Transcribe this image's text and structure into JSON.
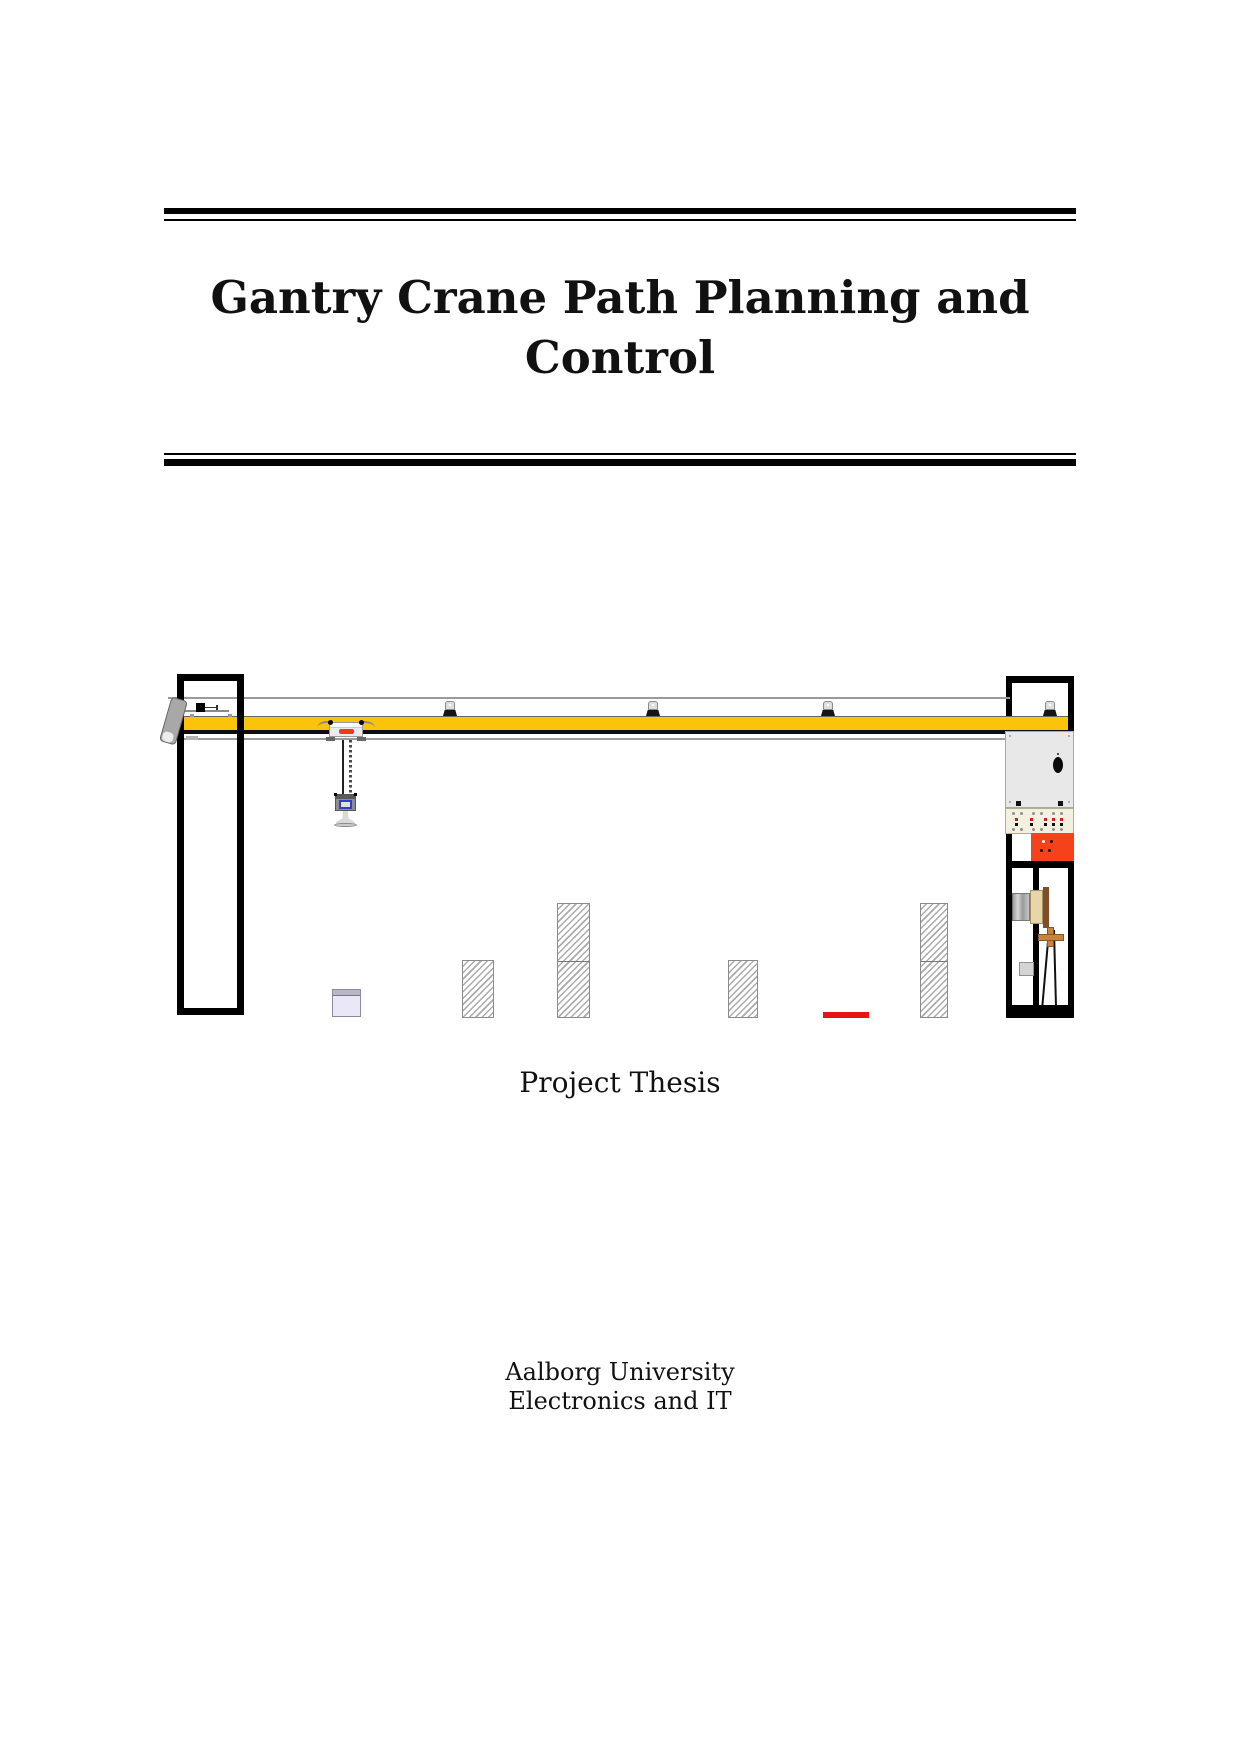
{
  "header": {
    "title_line1": "Gantry Crane Path Planning and",
    "title_line2": "Control"
  },
  "subtitle": {
    "text": "Project Thesis"
  },
  "footer": {
    "institution_line1": "Aalborg University",
    "institution_line2": "Electronics and IT"
  },
  "figure": {
    "name": "gantry-crane-system-drawing",
    "description": "Side-view technical drawing of a laboratory gantry crane: a yellow bridge beam on two black support towers, a trolley with hanging chain hoist and bell-shaped gripper, three signal beacons on the beam, hatched rectangular obstacles on the ground, a small lavender payload box, a red target marker, and an electrical control column on the right with cabinet, terminal strip, red power box and hoist motor with pendulum rods.",
    "colors": {
      "beam_yellow": "#FCC30B",
      "frame_black": "#000000",
      "trolley_stripe_red": "#F23B12",
      "target_red": "#E81313",
      "cabinet_gray": "#E8E8E8",
      "terminal_cream": "#F4F0DF",
      "power_box_red": "#F5421B",
      "payload_lavender": "#E9E7F8",
      "motor_tan": "#C8833C",
      "obstacle_hatch_gray": "#ABABAB",
      "rail_gray": "#9A9A9A"
    }
  }
}
